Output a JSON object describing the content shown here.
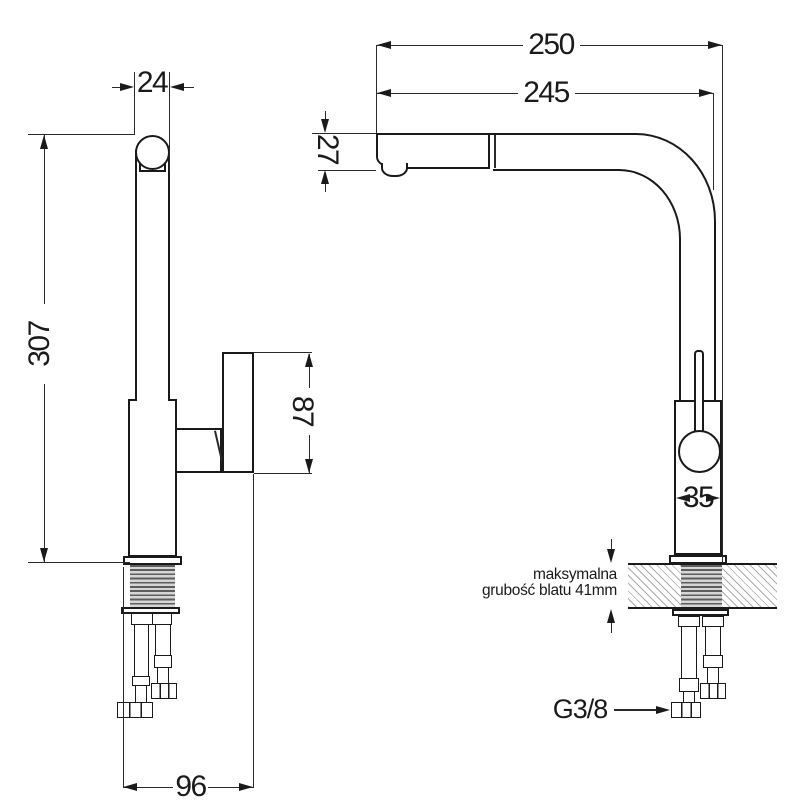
{
  "side_view": {
    "dim_spout_top_width": "24",
    "dim_total_height": "307",
    "dim_handle_length": "87",
    "dim_base_depth": "96"
  },
  "front_view": {
    "dim_total_reach": "250",
    "dim_spout_reach": "245",
    "dim_spout_drop": "27",
    "dim_body_width": "35",
    "countertop_note_line1": "maksymalna",
    "countertop_note_line2": "grubość blatu 41mm",
    "thread_label": "G3/8"
  },
  "colors": {
    "line": "#1a1a1a",
    "hatch": "#ababab",
    "thread_dark": "#5d5d5d"
  }
}
